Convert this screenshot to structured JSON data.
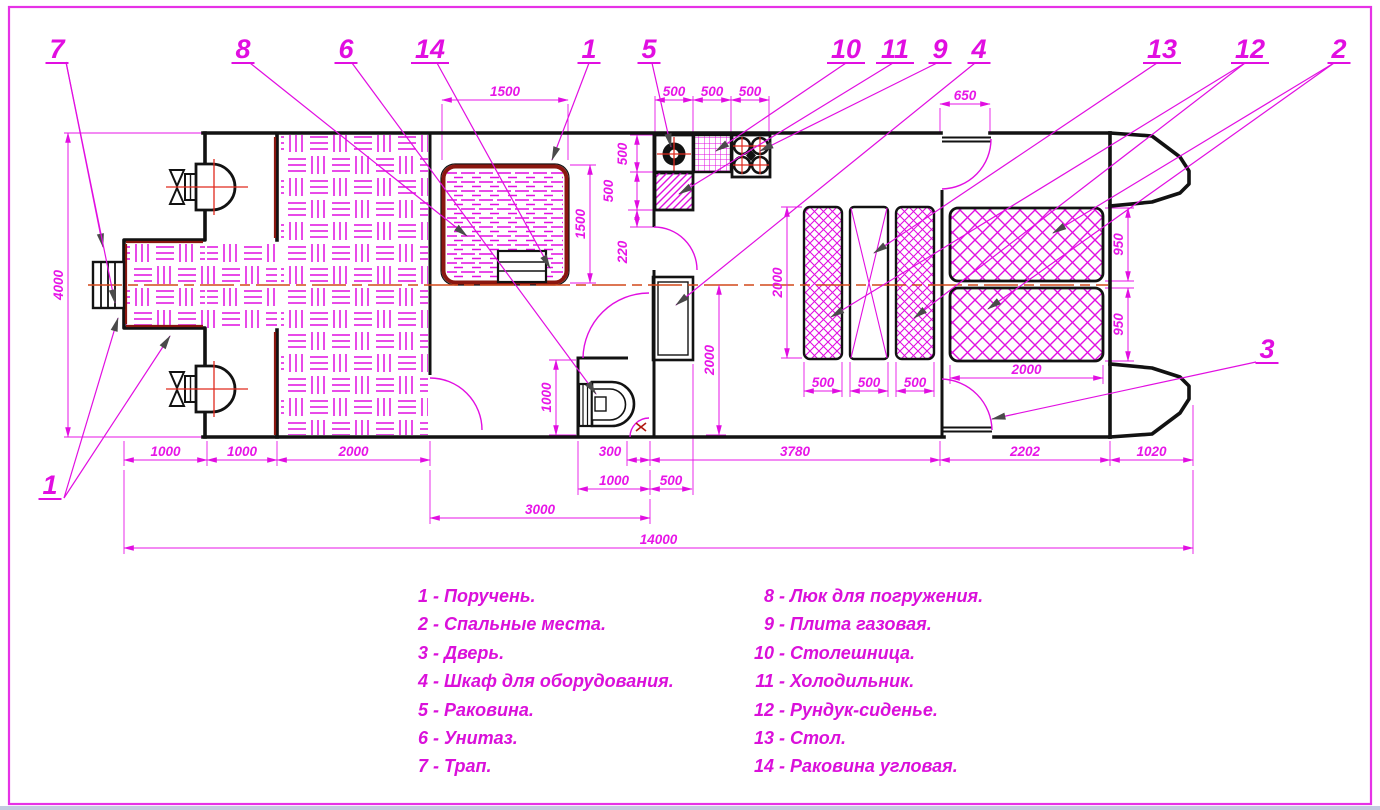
{
  "drawing": {
    "title": "Boat interior floor plan (dive pontoon boat)",
    "colors": {
      "magenta": "#e10ee1",
      "dim_text": "#e716e7",
      "legend_text": "#da10da",
      "wall_black": "#121212",
      "handrail_maroon": "#8a1710",
      "centerline_red": "#d2491a",
      "detail_red": "#e02a1e",
      "leader_arrow": "#4a4a4a",
      "border_magenta": "#e632e6",
      "bottom_strip": "#c3cbe0"
    },
    "callouts": [
      {
        "num": "7",
        "x": 57,
        "y": 58,
        "leaders": [
          [
            66,
            62,
            103,
            247
          ],
          [
            66,
            62,
            115,
            303
          ]
        ]
      },
      {
        "num": "8",
        "x": 243,
        "y": 58,
        "leaders": [
          [
            250,
            63,
            467,
            236
          ]
        ]
      },
      {
        "num": "6",
        "x": 346,
        "y": 58,
        "leaders": [
          [
            352,
            63,
            596,
            394
          ]
        ]
      },
      {
        "num": "14",
        "x": 430,
        "y": 58,
        "leaders": [
          [
            437,
            63,
            550,
            268
          ]
        ]
      },
      {
        "num": "1",
        "x": 589,
        "y": 58,
        "leaders": [
          [
            589,
            63,
            552,
            160
          ]
        ]
      },
      {
        "num": "5",
        "x": 649,
        "y": 58,
        "leaders": [
          [
            652,
            63,
            671,
            147
          ]
        ]
      },
      {
        "num": "10",
        "x": 846,
        "y": 58,
        "leaders": [
          [
            846,
            63,
            716,
            151
          ]
        ]
      },
      {
        "num": "11",
        "x": 895,
        "y": 58,
        "leaders": [
          [
            893,
            63,
            679,
            194
          ]
        ]
      },
      {
        "num": "9",
        "x": 940,
        "y": 58,
        "leaders": [
          [
            937,
            63,
            760,
            151
          ]
        ]
      },
      {
        "num": "4",
        "x": 979,
        "y": 58,
        "leaders": [
          [
            975,
            63,
            676,
            305
          ]
        ]
      },
      {
        "num": "13",
        "x": 1162,
        "y": 58,
        "leaders": [
          [
            1157,
            63,
            874,
            253
          ]
        ]
      },
      {
        "num": "12",
        "x": 1250,
        "y": 58,
        "leaders": [
          [
            1245,
            63,
            831,
            317
          ],
          [
            1245,
            63,
            914,
            318
          ]
        ]
      },
      {
        "num": "2",
        "x": 1339,
        "y": 58,
        "leaders": [
          [
            1334,
            63,
            1053,
            233
          ],
          [
            1334,
            63,
            988,
            309
          ]
        ]
      },
      {
        "num": "1",
        "x": 50,
        "y": 494,
        "leaders": [
          [
            64,
            498,
            170,
            336
          ],
          [
            64,
            498,
            118,
            318
          ]
        ]
      },
      {
        "num": "3",
        "x": 1267,
        "y": 358,
        "leaders": [
          [
            1256,
            362,
            992,
            419
          ]
        ]
      }
    ],
    "dims_h": [
      {
        "v": "1500",
        "x1": 442,
        "x2": 568,
        "y": 100
      },
      {
        "v": "500",
        "x1": 655,
        "x2": 693,
        "y": 100
      },
      {
        "v": "500",
        "x1": 693,
        "x2": 731,
        "y": 100
      },
      {
        "v": "500",
        "x1": 731,
        "x2": 769,
        "y": 100
      },
      {
        "v": "650",
        "x1": 940,
        "x2": 990,
        "y": 104
      },
      {
        "v": "2000",
        "x1": 950,
        "x2": 1103,
        "y": 378
      },
      {
        "v": "500",
        "x1": 804,
        "x2": 842,
        "y": 391
      },
      {
        "v": "500",
        "x1": 850,
        "x2": 888,
        "y": 391
      },
      {
        "v": "500",
        "x1": 896,
        "x2": 934,
        "y": 391
      },
      {
        "v": "1000",
        "x1": 124,
        "x2": 207,
        "y": 460
      },
      {
        "v": "1000",
        "x1": 207,
        "x2": 277,
        "y": 460
      },
      {
        "v": "2000",
        "x1": 277,
        "x2": 430,
        "y": 460
      },
      {
        "v": "300",
        "x1": 627,
        "x2": 650,
        "y": 460,
        "tx": 610
      },
      {
        "v": "3780",
        "x1": 650,
        "x2": 940,
        "y": 460
      },
      {
        "v": "2202",
        "x1": 940,
        "x2": 1110,
        "y": 460
      },
      {
        "v": "1020",
        "x1": 1110,
        "x2": 1193,
        "y": 460
      },
      {
        "v": "1000",
        "x1": 578,
        "x2": 650,
        "y": 489
      },
      {
        "v": "500",
        "x1": 650,
        "x2": 692,
        "y": 489
      },
      {
        "v": "3000",
        "x1": 430,
        "x2": 650,
        "y": 518
      },
      {
        "v": "14000",
        "x1": 124,
        "x2": 1193,
        "y": 548
      }
    ],
    "dims_v": [
      {
        "v": "4000",
        "x": 68,
        "y1": 133,
        "y2": 437
      },
      {
        "v": "1500",
        "x": 590,
        "y1": 165,
        "y2": 283
      },
      {
        "v": "500",
        "x": 637,
        "y1": 135,
        "y2": 172,
        "tx": 627,
        "ty": 154
      },
      {
        "v": "500",
        "x": 637,
        "y1": 172,
        "y2": 210,
        "tx": 613,
        "ty": 191
      },
      {
        "v": "220",
        "x": 637,
        "y1": 210,
        "y2": 227,
        "tx": 627,
        "ty": 252
      },
      {
        "v": "2000",
        "x": 719,
        "y1": 285,
        "y2": 435
      },
      {
        "v": "2000",
        "x": 787,
        "y1": 207,
        "y2": 358
      },
      {
        "v": "1000",
        "x": 556,
        "y1": 360,
        "y2": 435
      },
      {
        "v": "950",
        "x": 1128,
        "y1": 208,
        "y2": 281
      },
      {
        "v": "950",
        "x": 1128,
        "y1": 288,
        "y2": 361
      }
    ],
    "legend": {
      "left": [
        {
          "num": "1",
          "label": "Поручень."
        },
        {
          "num": "2",
          "label": "Спальные места."
        },
        {
          "num": "3",
          "label": "Дверь."
        },
        {
          "num": "4",
          "label": "Шкаф для оборудования."
        },
        {
          "num": "5",
          "label": "Раковина."
        },
        {
          "num": "6",
          "label": "Унитаз."
        },
        {
          "num": "7",
          "label": "Трап."
        }
      ],
      "right": [
        {
          "num": "8",
          "label": "Люк для погружения."
        },
        {
          "num": "9",
          "label": "Плита газовая."
        },
        {
          "num": "10",
          "label": "Столешница."
        },
        {
          "num": "11",
          "label": "Холодильник."
        },
        {
          "num": "12",
          "label": "Рундук-сиденье."
        },
        {
          "num": "13",
          "label": "Стол."
        },
        {
          "num": "14",
          "label": "Раковина угловая."
        }
      ]
    }
  }
}
